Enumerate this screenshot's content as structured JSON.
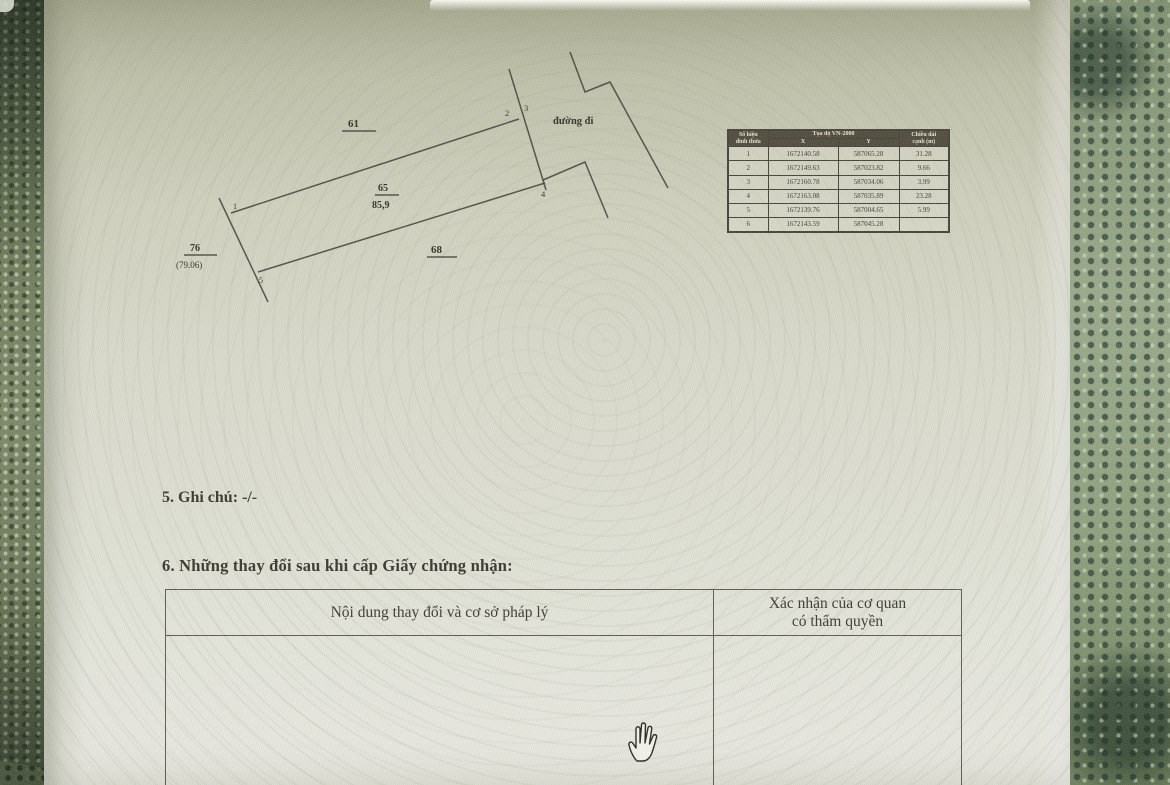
{
  "photo_background": {
    "lace_left_color": "#6f7a5e",
    "lace_right_color": "#95a483"
  },
  "paper": {
    "color": "#d9dacb",
    "ink_color": "#3a392f"
  },
  "sketch": {
    "road_label": "đường đi",
    "parcel_number": "65",
    "parcel_area": "85,9",
    "adjacent_top_parcel": "61",
    "adjacent_bottom_parcel": "68",
    "adjacent_left_parcel": "76",
    "adjacent_left_area": "(79.06)",
    "vertex_labels": {
      "v1": "1",
      "v2": "2",
      "v3": "3",
      "v4": "4",
      "v5": "5"
    }
  },
  "coord_table": {
    "corner_header_line1": "Số hiệu",
    "corner_header_line2": "đỉnh thửa",
    "main_header": "Tọa độ VN-2000",
    "col_x": "X",
    "col_y": "Y",
    "length_header_line1": "Chiều dài",
    "length_header_line2": "cạnh (m)",
    "rows": [
      {
        "v": "1",
        "x": "1672140.58",
        "y": "587065.28",
        "len": "31.28"
      },
      {
        "v": "2",
        "x": "1672149.63",
        "y": "587023.82",
        "len": "9.66"
      },
      {
        "v": "3",
        "x": "1672160.78",
        "y": "587034.06",
        "len": "3.99"
      },
      {
        "v": "4",
        "x": "1672163.08",
        "y": "587035.89",
        "len": "23.28"
      },
      {
        "v": "5",
        "x": "1672139.76",
        "y": "587004.65",
        "len": "5.99"
      },
      {
        "v": "6",
        "x": "1672143.59",
        "y": "587045.28",
        "len": ""
      }
    ]
  },
  "sections": {
    "note": "5. Ghi chú: -/-",
    "changes_heading": "6. Những thay đổi sau khi cấp Giấy chứng nhận:",
    "changes_col1_header": "Nội dung thay đổi và cơ sở pháp lý",
    "changes_col2_header_line1": "Xác nhận của cơ quan",
    "changes_col2_header_line2": "có thẩm quyền"
  }
}
